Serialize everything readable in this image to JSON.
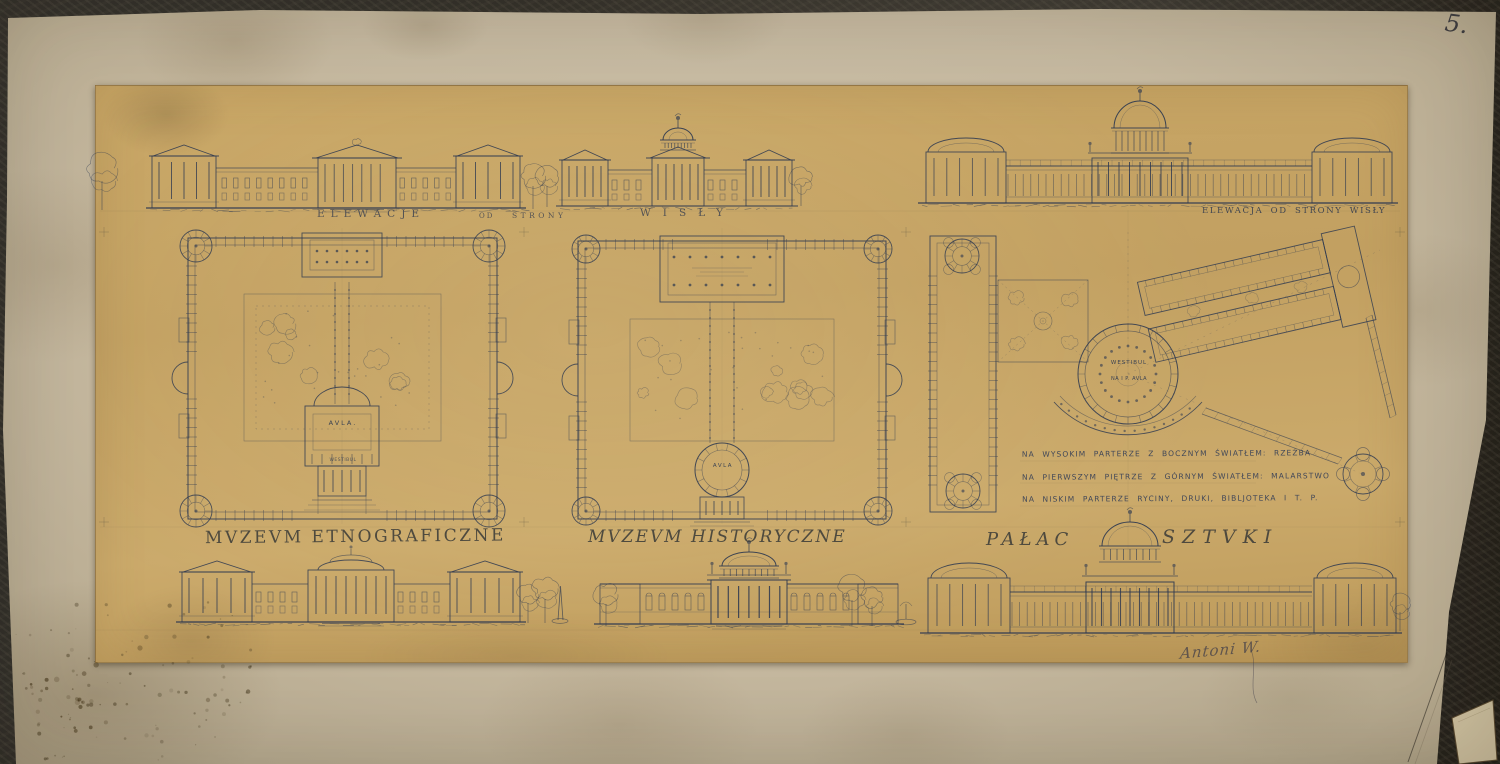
{
  "artwork": {
    "sheet_number": "5.",
    "signature": "Antoni W.",
    "captions": {
      "elevations_row": [
        "ELEWACJE",
        "OD",
        "STRONY",
        "WISŁY"
      ],
      "right_elevation": "ELEWACJA OD STRONY WISŁY"
    },
    "titles": {
      "left": "MVZEVM ETNOGRAFICZNE",
      "middle": "MVZEVM HISTORYCZNE",
      "right_word1": "PAŁAC",
      "right_word2": "SZTVKI"
    },
    "notes": [
      "NA WYSOKIM PARTERZE Z BOCZNYM ŚWIATŁEM: RZEŹBA",
      "NA PIERWSZYM PIĘTRZE Z GÓRNYM ŚWIATŁEM: MALARSTWO",
      "NA NISKIM PARTERZE RYCINY, DRUKI, BIBLJOTEKA I T. P."
    ],
    "plan_labels": {
      "ethnographic_aula": "AVLA.",
      "ethnographic_vestibule": "WESTIBUL",
      "historical_aula": "AVLA",
      "art_palace_vestibule": "WESTIBUL",
      "art_palace_upper_aula": "NA I P. AVLA"
    },
    "colors": {
      "ink": "#2b3750",
      "panel_paper": "#c6a465",
      "sheet_paper": "#c4b79d",
      "backdrop": "#2b2823",
      "pencil": "#55503e"
    }
  }
}
